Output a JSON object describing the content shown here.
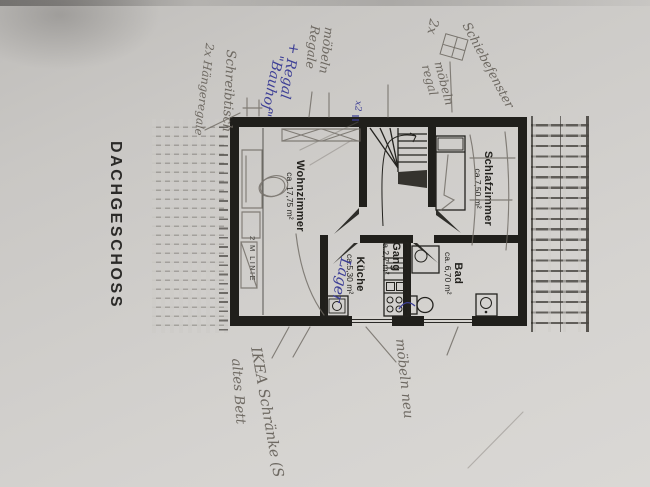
{
  "page": {
    "title": "DACHGESCHOSS"
  },
  "plan": {
    "rooms": [
      {
        "id": "wohnzimmer",
        "name": "Wohnzimmer",
        "area": "ca. 17,75 m²"
      },
      {
        "id": "gang",
        "name": "Gang",
        "area": "ca.2,7 m²"
      },
      {
        "id": "schlafzimmer",
        "name": "Schlafzimmer",
        "area": "ca.7,50 m²"
      },
      {
        "id": "kueche",
        "name": "Küche",
        "area": "ca.5,30 m²"
      },
      {
        "id": "bad",
        "name": "Bad",
        "area": "ca. 6,70 m²"
      }
    ],
    "marks": {
      "two_meter_line": "2 M LINIE"
    },
    "fixtures": [
      "stairs-icon",
      "bed-icon",
      "shower-icon",
      "toilet-icon",
      "washbasin-icon",
      "kitchen-sink-icon",
      "stove-icon",
      "washing-machine-icon",
      "window-sketch-icon"
    ]
  },
  "annotations": {
    "pencil": [
      {
        "text": "Schreibtisch"
      },
      {
        "text": "2x Hängeregale"
      },
      {
        "text": "möbeln Regale"
      },
      {
        "text": "möbeln regal"
      },
      {
        "text": "2x"
      },
      {
        "text": "Schiebefenster"
      },
      {
        "text": "IKEA Schränke (S"
      },
      {
        "text": "altes Bett"
      },
      {
        "text": "möbeln neu"
      }
    ],
    "ink": [
      {
        "text": "+ Regal"
      },
      {
        "text": "\"Bauhof\""
      },
      {
        "text": "x2"
      },
      {
        "text": "Lager"
      }
    ]
  },
  "colors": {
    "paper": "#cfcdca",
    "print": "#23221e",
    "pencil": "#6e6962",
    "ink": "#3d3f96"
  }
}
